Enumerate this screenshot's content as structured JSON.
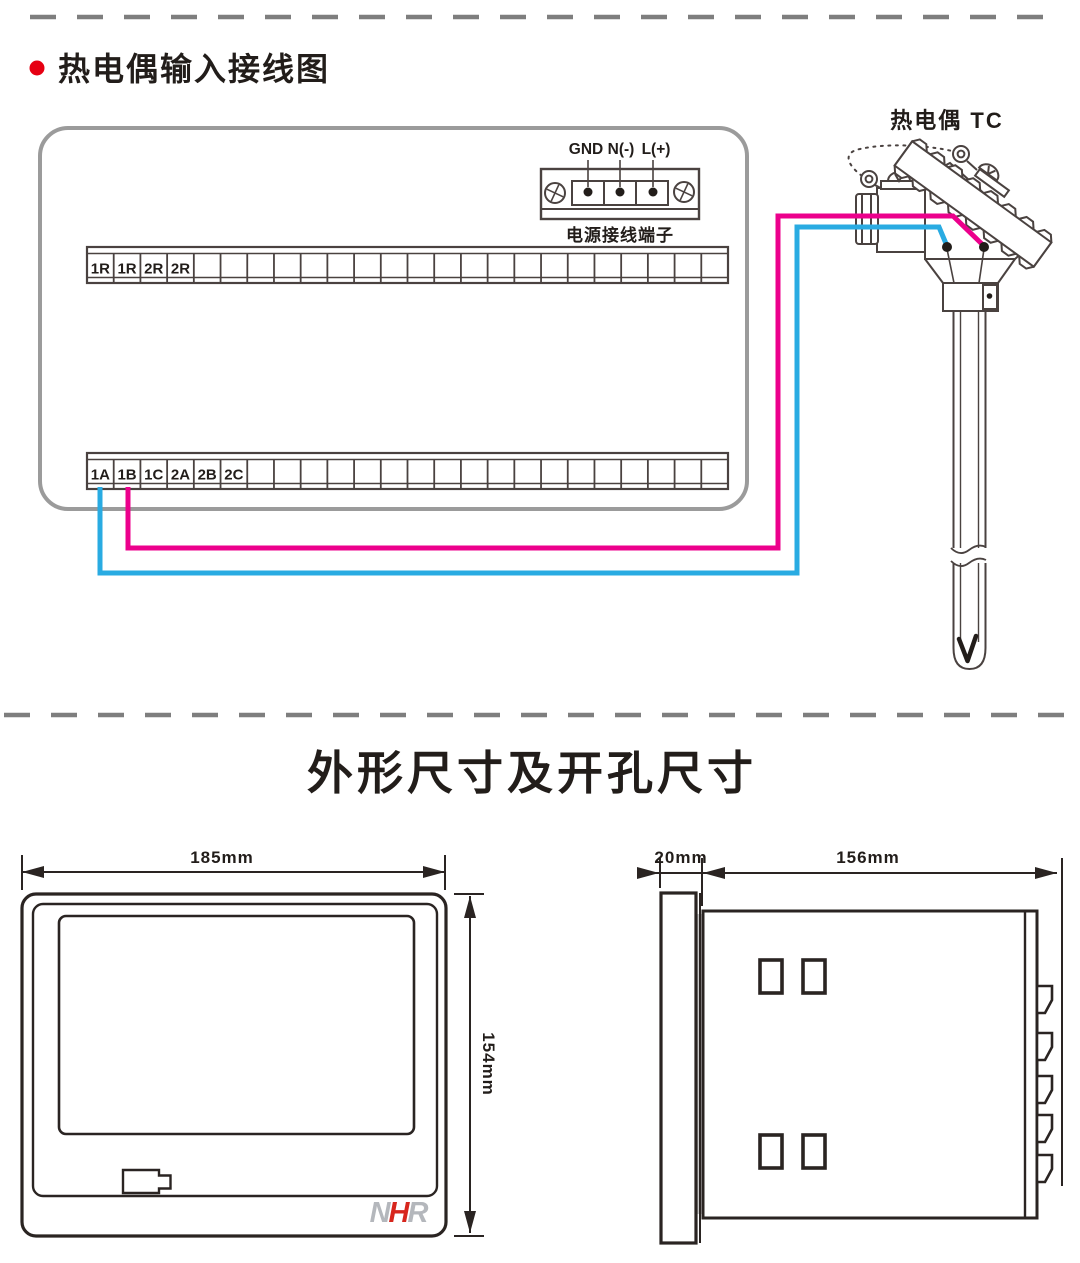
{
  "section1": {
    "bullet_color": "#e60012",
    "title": "热电偶输入接线图"
  },
  "wiring": {
    "power_terminal": {
      "labels": [
        "GND",
        "N(-)",
        "L(+)"
      ],
      "caption": "电源接线端子"
    },
    "strip_top": {
      "labels": [
        "1R",
        "1R",
        "2R",
        "2R"
      ],
      "total_cells": 24
    },
    "strip_bottom": {
      "labels": [
        "1A",
        "1B",
        "1C",
        "2A",
        "2B",
        "2C"
      ],
      "total_cells": 24
    },
    "thermocouple_label": "热电偶 TC",
    "wire_positive_color": "#ec008c",
    "wire_negative_color": "#29abe2",
    "ink_color": "#4a4240",
    "panel_color": "#9b9b9b"
  },
  "section2": {
    "title": "外形尺寸及开孔尺寸"
  },
  "front_view": {
    "width_label": "185mm",
    "height_label": "154mm"
  },
  "side_view": {
    "depth_label": "20mm",
    "body_label": "156mm"
  },
  "logo": {
    "n": "N",
    "h": "H",
    "r": "R",
    "gray_color": "#b4b7bc",
    "red_color": "#d7261d"
  }
}
